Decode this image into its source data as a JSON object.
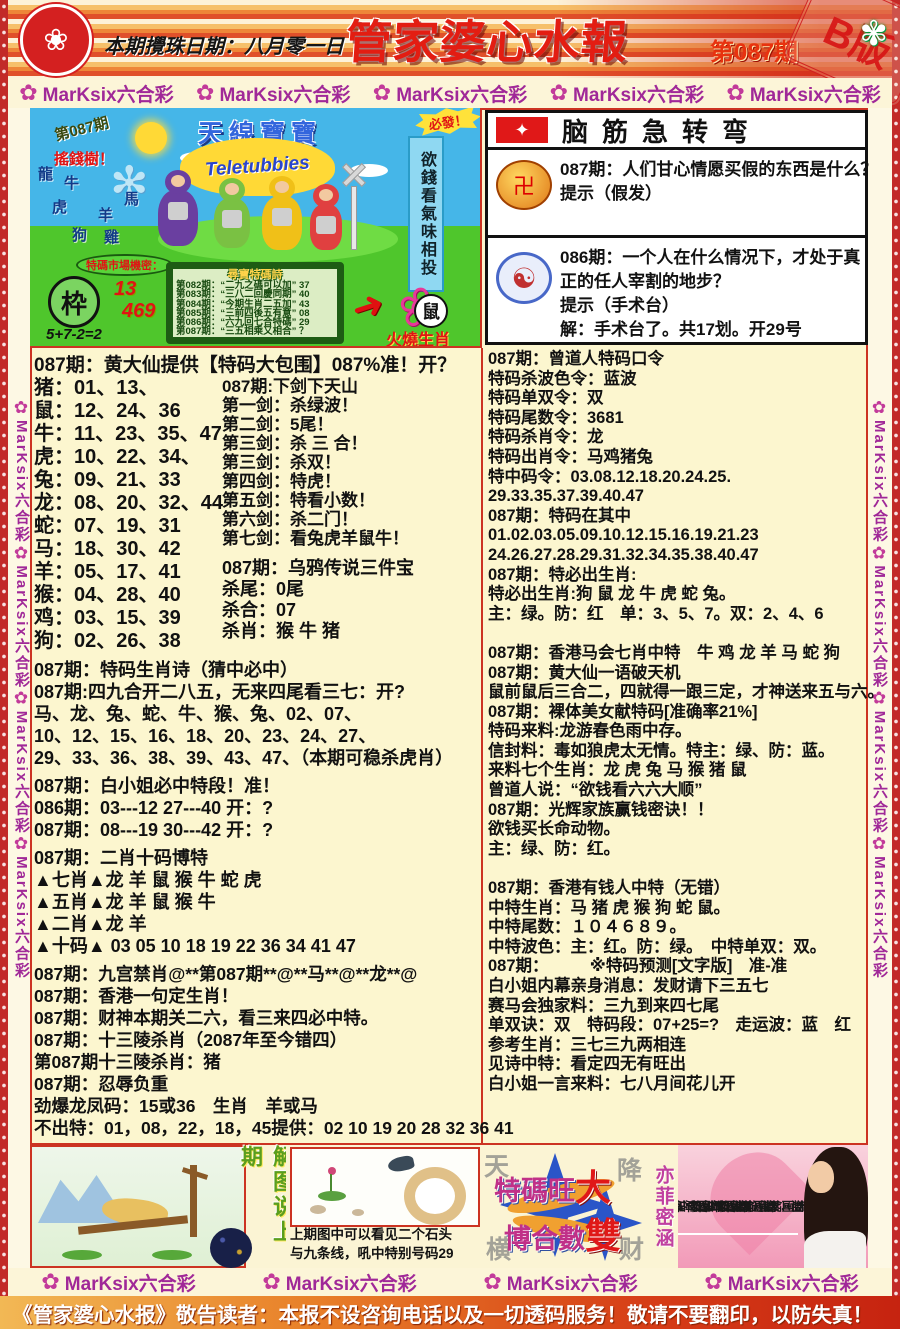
{
  "header": {
    "date_label": "本期攪珠日期：八月零一日",
    "title": "管家婆心水報",
    "issue": "第087期",
    "stamp": "B版",
    "accent_red": "#e31d12"
  },
  "banner": {
    "label": "MarKsix六合彩",
    "flower": "✿"
  },
  "cartoon": {
    "issue": "第087期",
    "money_tree": "搖錢樹！",
    "tree_zodiacs": [
      "龍",
      "牛",
      "馬",
      "虎",
      "羊",
      "狗",
      "雞"
    ],
    "show_title": "天線寶寶",
    "logo": "Teletubbies",
    "burst": "必發！",
    "blue_banner": "欲錢看氣味相投",
    "bubble": "特碼市場機密：",
    "seal_char": "枠",
    "num1": "13",
    "num2": "469",
    "formula": "5+7-2=2",
    "board_title": "尋寶特碼詩",
    "board_rows": [
      "第082期：“二九之碼可以加” 37",
      "第083期：“三八二回慶同期” 40",
      "第084期：“今期生肖二五加” 43",
      "第085期：“三前四後五有意” 08",
      "第086期：“六九回七合特碼” 29",
      "第087期：“三五相乘又相合” ？"
    ],
    "rat_char": "鼠",
    "fire_label": "火燒生肖"
  },
  "bt": {
    "title": "脑筋急转弯",
    "flag_star": "✦",
    "medal_char": "卍",
    "yinyang_char": "☯",
    "q1a": "087期：人们甘心情愿买假的东西是什么？",
    "q1b": "提示（假发）",
    "q2a": "086期：一个人在什么情况下，才处于真",
    "q2b": "正的任人宰割的地步？",
    "q2c": "提示（手术台）",
    "q2d": "解：手术台了。共17划。开29号"
  },
  "left": {
    "heading": "087期：黄大仙提供【特码大包围】087%准！开？",
    "zodiac": [
      "猪：01、13、",
      "鼠：12、24、36",
      "牛：11、23、35、47",
      "虎：10、22、34、",
      "兔：09、21、33",
      "龙：08、20、32、44",
      "蛇：07、19、31",
      "马：18、30、42",
      "羊：05、17、41",
      "猴：04、28、40",
      "鸡：03、15、39",
      "狗：02、26、38"
    ],
    "swords": [
      "087期:下剑下天山",
      "第一剑：杀绿波！",
      "第二剑：5尾！",
      "第三剑：杀 三 合！",
      "第三剑：杀双！",
      "第四剑：特虎！",
      "第五剑：特看小数！",
      "第六剑：杀二门！",
      "第七剑：看兔虎羊鼠牛！"
    ],
    "crow": [
      "087期：乌鸦传说三件宝",
      "杀尾：0尾",
      "杀合：07",
      "杀肖：猴 牛 猪"
    ],
    "poem": [
      "087期：特码生肖诗（猜中必中）",
      "087期:四九合开二八五，无来四尾看三七：开?",
      "马、龙、兔、蛇、牛、猴、兔、02、07、",
      "10、12、15、16、18、20、23、24、27、",
      "29、33、36、38、39、43、47、（本期可稳杀虎肖）"
    ],
    "duan": [
      "087期：白小姐必中特段！准！",
      "086期：03---12  27---40  开：?",
      "087期：08---19  30---42  开：?"
    ],
    "erxiao": [
      "087期：二肖十码博特",
      "▲七肖▲龙 羊 鼠 猴 牛 蛇 虎",
      "▲五肖▲龙 羊 鼠 猴 牛",
      "▲二肖▲龙 羊",
      "▲十码▲ 03 05 10 18 19 22 36 34 41 47"
    ],
    "misc": [
      "087期：九宫禁肖@**第087期**@**马**@**龙**@",
      "087期：香港一句定生肖！",
      "087期：财神本期关二六，看三来四必中特。",
      "087期：十三陵杀肖（2087年至今错四）",
      "第087期十三陵杀肖：猪",
      "087期：忍辱负重",
      "劲爆龙凤码：15或36　生肖　羊或马",
      "不出特：01，08，22，18，45提供：02 10 19 20 28 32 36 41"
    ]
  },
  "right": {
    "lines": [
      "087期：曾道人特码口令",
      "特码杀波色令：蓝波",
      "特码单双令：双",
      "特码尾数令：3681",
      "特码杀肖令：龙",
      "特码出肖令：马鸡猪兔",
      "特中码令：03.08.12.18.20.24.25.",
      "29.33.35.37.39.40.47",
      "087期：特码在其中",
      "01.02.03.05.09.10.12.15.16.19.21.23",
      "24.26.27.28.29.31.32.34.35.38.40.47",
      "087期：特必出生肖:",
      "特必出生肖:狗 鼠 龙 牛 虎 蛇 兔。",
      "主：绿。防：红　单：3、5、7。双：2、4、6",
      "",
      "087期：香港马会七肖中特　牛 鸡 龙 羊 马 蛇 狗",
      "087期：黄大仙一语破天机",
      "鼠前鼠后三合二，四就得一跟三定，才神送来五与六。",
      "087期：裸体美女献特码[准确率21%]",
      "特码来料:龙游春色雨中存。",
      "信封料：毒如狼虎太无情。特主：绿、防：蓝。",
      "来料七个生肖：龙 虎 兔 马 猴 猪 鼠",
      "曾道人说：“欲钱看六六大顺”",
      "087期：光辉家族赢钱密诀！！",
      "欲钱买长命动物。",
      "主：绿、防：红。",
      "",
      "087期：香港有钱人中特（无错）",
      "中特生肖：马 猪 虎 猴 狗 蛇 鼠。",
      "中特尾数：１０４６８９。",
      "中特波色：主：红。防：绿。　中特单双：双。",
      "087期：　　　※特码预测[文字版]　准-准",
      "白小姐内幕亲身消息：发财请下三五七",
      "赛马会独家料：三九到来四七尾",
      "单双诀：双　特码段：07+25=?　走运波：蓝　红",
      "参考生肖：三七三九两相连",
      "见诗中特：看定四无有旺出",
      "白小姐一言来料：七八月间花儿开"
    ]
  },
  "bottom": {
    "jietu_title": "解图说上期",
    "caption1": "上期图中可以看见二个石头",
    "caption2": "与九条线，吼中特别号码29",
    "star_text1": "特碼旺",
    "star_text2": "博合數",
    "star_big1": "大",
    "star_big2": "雙",
    "bg1": "天",
    "bg2": "降",
    "bg3": "横",
    "bg4": "财",
    "yifei": "亦菲密涵",
    "pink_col": "期：看圖解碼得兔財"
  },
  "footer": {
    "notice": "《管家婆心水报》敬告读者：本报不设咨询电话以及一切透码服务！敬请不要翻印，以防失真！"
  }
}
